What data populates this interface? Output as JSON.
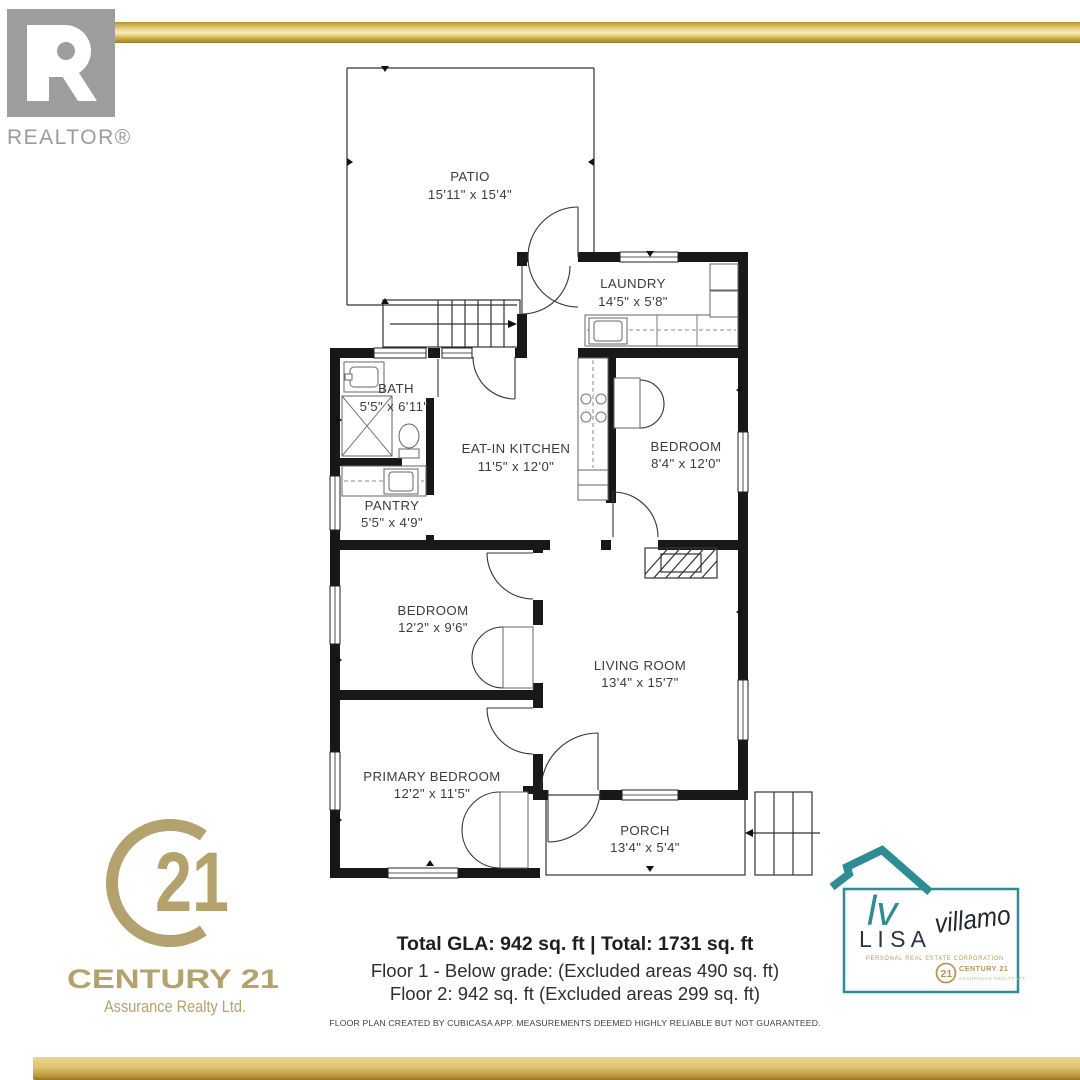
{
  "branding": {
    "realtor": {
      "label": "REALTOR®"
    },
    "century21": {
      "emblem_number": "21",
      "name": "CENTURY 21",
      "subtitle": "Assurance Realty Ltd.",
      "gold": "#b3a26d"
    },
    "agent": {
      "monogram": "lv",
      "first_name": "L I S A",
      "last_name": "villamo",
      "tagline": "PERSONAL REAL ESTATE CORPORATION",
      "seal_number": "21",
      "brokerage_line1": "CENTURY 21",
      "brokerage_line2": "ASSURANCE REALTY LTD.",
      "teal": "#2e8c94",
      "gold": "#b5975a"
    }
  },
  "summary": {
    "total_line": "Total GLA: 942 sq. ft | Total: 1731 sq. ft",
    "floor1_line": "Floor 1 - Below grade: (Excluded areas 490 sq. ft)",
    "floor2_line": "Floor 2: 942 sq. ft (Excluded areas 299 sq. ft)",
    "disclaimer": "FLOOR PLAN CREATED BY CUBICASA APP. MEASUREMENTS DEEMED HIGHLY RELIABLE BUT NOT GUARANTEED."
  },
  "floorplan": {
    "rooms": [
      {
        "name": "PATIO",
        "dims": "15'11\" x 15'4\""
      },
      {
        "name": "LAUNDRY",
        "dims": "14'5\" x 5'8\""
      },
      {
        "name": "BATH",
        "dims": "5'5\" x 6'11\""
      },
      {
        "name": "EAT-IN KITCHEN",
        "dims": "11'5\" x 12'0\""
      },
      {
        "name": "BEDROOM",
        "dims": "8'4\" x 12'0\""
      },
      {
        "name": "PANTRY",
        "dims": "5'5\" x 4'9\""
      },
      {
        "name": "BEDROOM",
        "dims": "12'2\" x 9'6\""
      },
      {
        "name": "LIVING ROOM",
        "dims": "13'4\" x 15'7\""
      },
      {
        "name": "PRIMARY BEDROOM",
        "dims": "12'2\" x 11'5\""
      },
      {
        "name": "PORCH",
        "dims": "13'4\" x 5'4\""
      }
    ]
  }
}
